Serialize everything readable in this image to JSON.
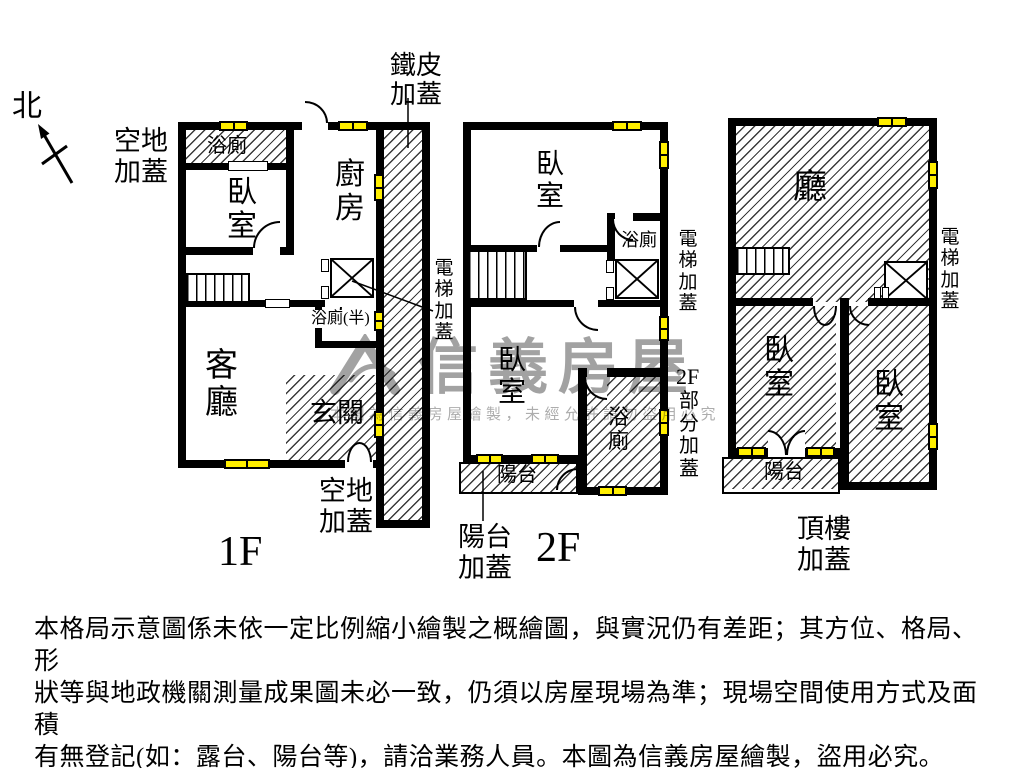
{
  "colors": {
    "wall": "#000000",
    "window_fill": "#ffee00",
    "hatch_line": "#3a3a3a",
    "watermark": "#a2a2a2"
  },
  "compass": {
    "label": "北"
  },
  "annotations": {
    "metal_cover": "鐵皮加蓋",
    "open_land_top": "空地加蓋",
    "open_land_bottom": "空地加蓋",
    "elevator_cover_1f": "電梯加蓋",
    "elevator_cover_2f": "電梯加蓋",
    "elevator_cover_roof": "電梯加蓋",
    "partial_cover_prefix": "2F",
    "partial_cover": "部分加蓋",
    "balcony_cover": "陽台加蓋",
    "roof_cover": "頂樓加蓋"
  },
  "floor1": {
    "label": "1F",
    "rooms": {
      "bath": "浴廁",
      "bedroom": "臥室",
      "kitchen": "廚房",
      "half_bath": "浴廁(半)",
      "living": "客廳",
      "foyer": "玄關"
    }
  },
  "floor2": {
    "label": "2F",
    "rooms": {
      "bedroom_top": "臥室",
      "bath_top": "浴廁",
      "bedroom_bottom": "臥室",
      "bath_bottom": "浴廁",
      "balcony": "陽台"
    }
  },
  "roof": {
    "rooms": {
      "hall": "廳",
      "bedroom_left": "臥室",
      "bedroom_right": "臥室",
      "balcony": "陽台"
    }
  },
  "watermark": {
    "brand": "信義房屋",
    "small": "本圖為信義房屋繪製，未經允許請勿盜用必究"
  },
  "disclaimer": {
    "lines": [
      "本格局示意圖係未依一定比例縮小繪製之概繪圖，與實況仍有差距；其方位、格局、形",
      "狀等與地政機關測量成果圖未必一致，仍須以房屋現場為準；現場空間使用方式及面積",
      "有無登記(如：露台、陽台等)，請洽業務人員。本圖為信義房屋繪製，盜用必究。"
    ]
  }
}
